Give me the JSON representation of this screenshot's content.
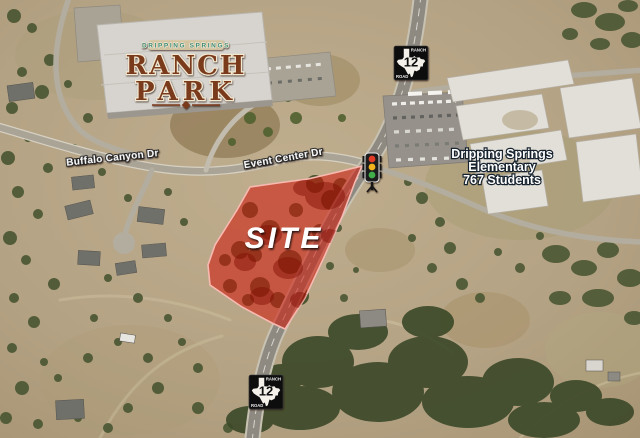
{
  "map": {
    "site": {
      "label": "SITE",
      "fill": "#ce1c0e",
      "border": "#f8b9b1"
    },
    "roads": {
      "buffalo_canyon_label": "Buffalo Canyon Dr",
      "event_center_label": "Event Center Dr"
    },
    "school_label": {
      "line1": "Dripping Springs",
      "line2": "Elementary",
      "line3": "767 Students"
    },
    "ranch_park_logo": {
      "banner": "DRIPPING SPRINGS",
      "line1": "RANCH",
      "line2": "PARK",
      "text_color": "#7a3a1c",
      "banner_color": "#3e8d7a"
    },
    "route_shields": [
      {
        "location": "north",
        "label_top": "RANCH",
        "number": "12",
        "label_bottom": "ROAD"
      },
      {
        "location": "south",
        "label_top": "RANCH",
        "number": "12",
        "label_bottom": "ROAD"
      }
    ],
    "icons": {
      "traffic_signal": "traffic-light-icon",
      "route_shield": "texas-route-shield-icon"
    }
  }
}
